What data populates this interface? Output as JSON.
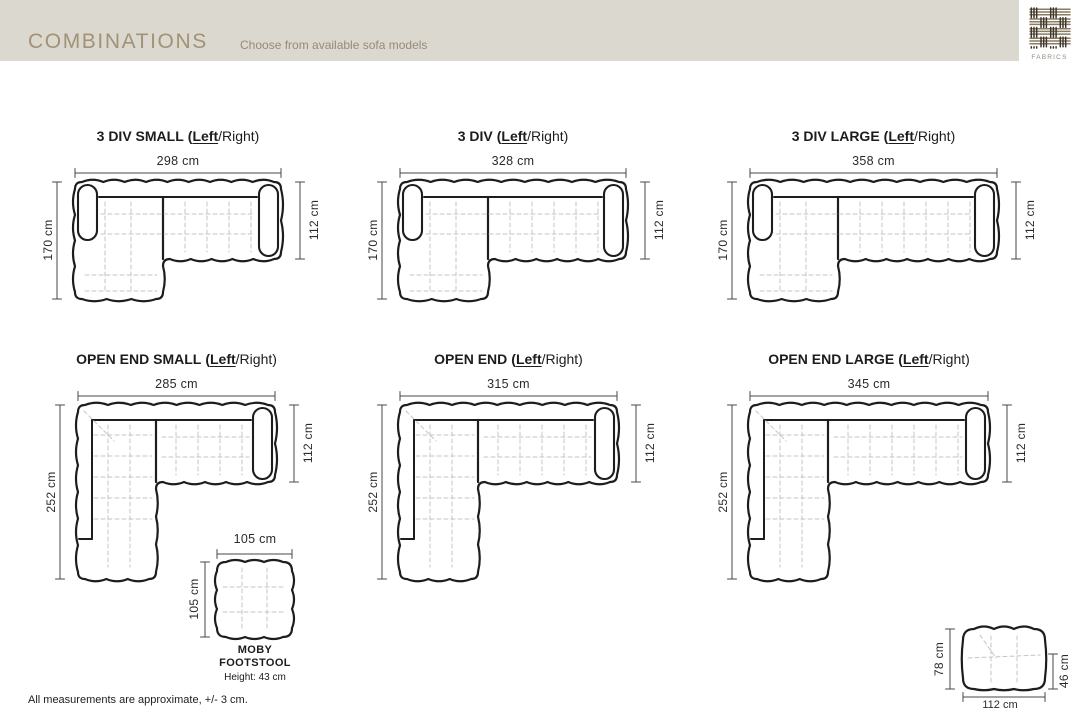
{
  "header": {
    "title": "COMBINATIONS",
    "subtitle": "Choose from available sofa models",
    "logo_label": "FABRICS",
    "bar_color": "#dbd8cf",
    "title_color": "#a29276"
  },
  "diagrams": [
    {
      "name": "3 DIV SMALL",
      "bracket": "(",
      "left_option": "Left",
      "right_option": "/Right)",
      "width_label": "298 cm",
      "height_label": "170 cm",
      "depth_label": "112 cm",
      "width_cm": 298,
      "height_cm": 170,
      "depth_cm": 112,
      "type": "sectional-3div"
    },
    {
      "name": "3 DIV",
      "bracket": "(",
      "left_option": "Left",
      "right_option": "/Right)",
      "width_label": "328 cm",
      "height_label": "170 cm",
      "depth_label": "112 cm",
      "width_cm": 328,
      "height_cm": 170,
      "depth_cm": 112,
      "type": "sectional-3div"
    },
    {
      "name": "3 DIV LARGE",
      "bracket": "(",
      "left_option": "Left",
      "right_option": "/Right)",
      "width_label": "358 cm",
      "height_label": "170 cm",
      "depth_label": "112 cm",
      "width_cm": 358,
      "height_cm": 170,
      "depth_cm": 112,
      "type": "sectional-3div"
    },
    {
      "name": "OPEN END SMALL",
      "bracket": "(",
      "left_option": "Left",
      "right_option": "/Right)",
      "width_label": "285 cm",
      "height_label": "252 cm",
      "depth_label": "112 cm",
      "width_cm": 285,
      "height_cm": 252,
      "depth_cm": 112,
      "type": "sectional-open-end"
    },
    {
      "name": "OPEN END",
      "bracket": "(",
      "left_option": "Left",
      "right_option": "/Right)",
      "width_label": "315 cm",
      "height_label": "252 cm",
      "depth_label": "112 cm",
      "width_cm": 315,
      "height_cm": 252,
      "depth_cm": 112,
      "type": "sectional-open-end"
    },
    {
      "name": "OPEN END LARGE",
      "bracket": "(",
      "left_option": "Left",
      "right_option": "/Right)",
      "width_label": "345 cm",
      "height_label": "252 cm",
      "depth_label": "112 cm",
      "width_cm": 345,
      "height_cm": 252,
      "depth_cm": 112,
      "type": "sectional-open-end"
    }
  ],
  "footstool": {
    "name_line1": "MOBY",
    "name_line2": "FOOTSTOOL",
    "height_note": "Height: 43 cm",
    "width_label": "105 cm",
    "depth_label": "105 cm",
    "width_cm": 105,
    "depth_cm": 105
  },
  "side_view": {
    "height_label": "78 cm",
    "seat_height_label": "46 cm",
    "width_label": "112 cm",
    "height_cm": 78,
    "seat_height_cm": 46,
    "width_cm": 112
  },
  "footnote": "All measurements are approximate, +/- 3 cm."
}
